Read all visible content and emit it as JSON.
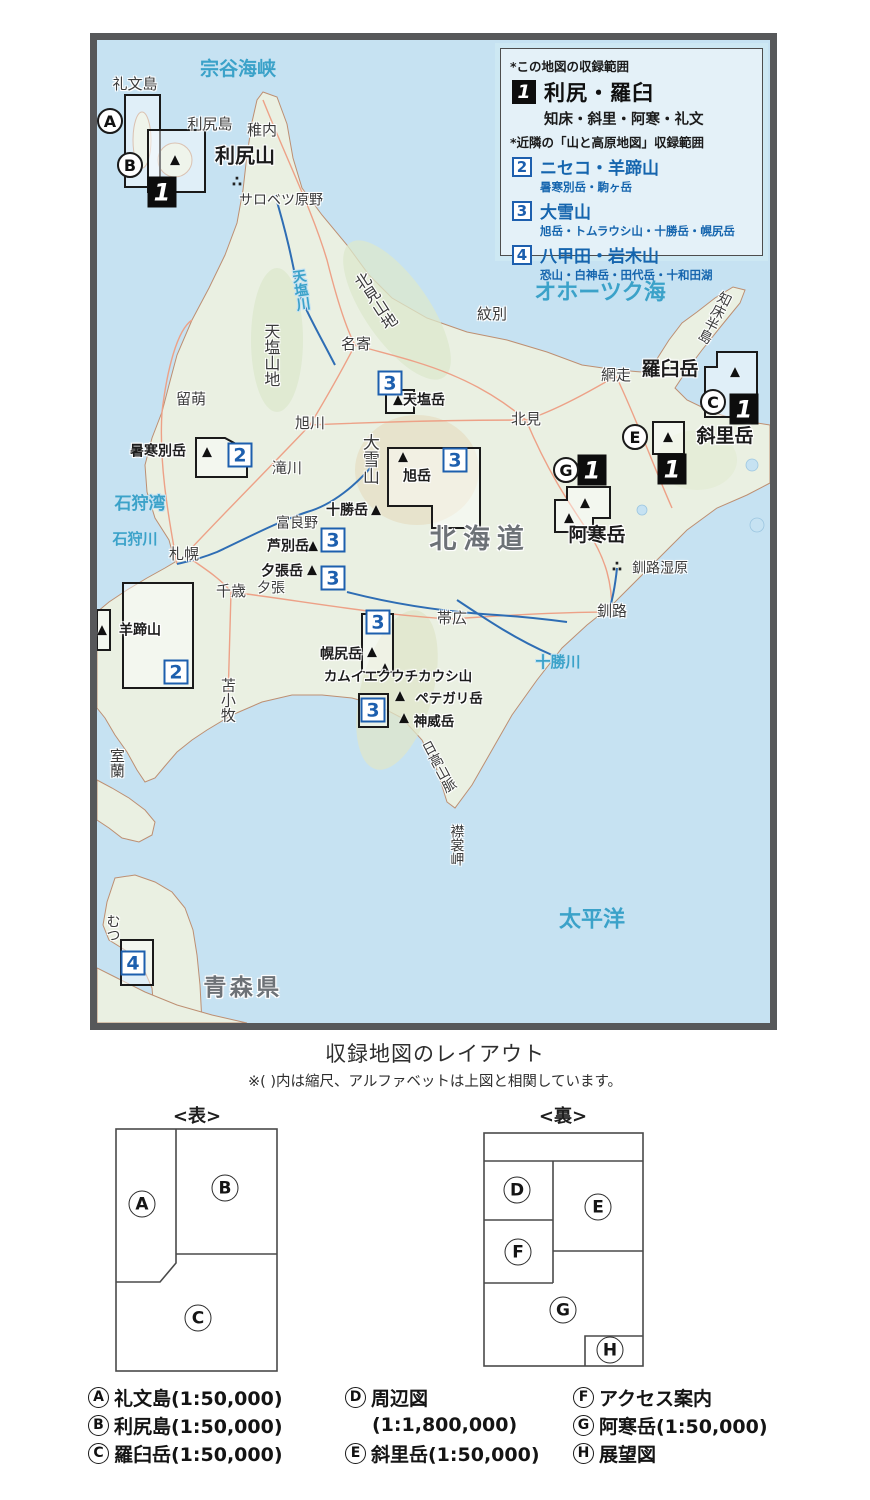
{
  "colors": {
    "ocean": "#c6e2f2",
    "land": "#eaf0e2",
    "coast": "#bd8f72",
    "river": "#2e6db4",
    "road": "#eda187",
    "accent_blue": "#1d5fae",
    "sea_text": "#3ba2c9"
  },
  "legend": {
    "note_this": "*この地図の収録範囲",
    "main": {
      "num": "1",
      "title": "利尻・羅臼",
      "sub": "知床・斜里・阿寒・礼文"
    },
    "note_nearby": "*近隣の「山と高原地図」収録範囲",
    "nearby": [
      {
        "num": "2",
        "title": "ニセコ・羊蹄山",
        "sub": "暑寒別岳・駒ヶ岳"
      },
      {
        "num": "3",
        "title": "大雪山",
        "sub": "旭岳・トムラウシ山・十勝岳・幌尻岳"
      },
      {
        "num": "4",
        "title": "八甲田・岩木山",
        "sub": "恐山・白神岳・田代岳・十和田湖"
      }
    ]
  },
  "map": {
    "labels": [
      {
        "t": "宗谷海峡",
        "x": 141,
        "y": 30,
        "s": 19,
        "c": "sea"
      },
      {
        "t": "オホーツク海",
        "x": 503,
        "y": 253,
        "s": 22,
        "c": "sea"
      },
      {
        "t": "石狩湾",
        "x": 43,
        "y": 465,
        "s": 17,
        "c": "sea"
      },
      {
        "t": "石狩川",
        "x": 38,
        "y": 500,
        "s": 15,
        "c": "sea"
      },
      {
        "t": "天塩川",
        "x": 203,
        "y": 250,
        "s": 14,
        "c": "sea",
        "v": 1,
        "r": -8
      },
      {
        "t": "十勝川",
        "x": 461,
        "y": 623,
        "s": 15,
        "c": "sea"
      },
      {
        "t": "太平洋",
        "x": 495,
        "y": 880,
        "s": 22,
        "c": "sea"
      },
      {
        "t": "礼文島",
        "x": 38,
        "y": 45,
        "s": 15
      },
      {
        "t": "利尻島",
        "x": 113,
        "y": 85,
        "s": 15
      },
      {
        "t": "稚内",
        "x": 165,
        "y": 91,
        "s": 15
      },
      {
        "t": "利尻山",
        "x": 148,
        "y": 116,
        "s": 20,
        "w": 1
      },
      {
        "t": "サロベツ原野",
        "x": 184,
        "y": 161,
        "s": 14
      },
      {
        "t": "北見山地",
        "x": 277,
        "y": 262,
        "s": 16,
        "v": 1,
        "r": -33
      },
      {
        "t": "天塩山地",
        "x": 173,
        "y": 315,
        "s": 16,
        "v": 1
      },
      {
        "t": "名寄",
        "x": 259,
        "y": 305,
        "s": 15
      },
      {
        "t": "紋別",
        "x": 395,
        "y": 275,
        "s": 15
      },
      {
        "t": "留萌",
        "x": 94,
        "y": 360,
        "s": 15
      },
      {
        "t": "旭川",
        "x": 213,
        "y": 384,
        "s": 15
      },
      {
        "t": "滝川",
        "x": 190,
        "y": 429,
        "s": 15
      },
      {
        "t": "網走",
        "x": 519,
        "y": 336,
        "s": 15
      },
      {
        "t": "北見",
        "x": 429,
        "y": 380,
        "s": 15
      },
      {
        "t": "知床半島",
        "x": 617,
        "y": 277,
        "s": 14,
        "v": 1,
        "r": 27
      },
      {
        "t": "羅臼岳",
        "x": 573,
        "y": 330,
        "s": 19,
        "w": 1
      },
      {
        "t": "斜里岳",
        "x": 628,
        "y": 397,
        "s": 19,
        "w": 1
      },
      {
        "t": "天塩岳",
        "x": 327,
        "y": 361,
        "s": 14,
        "w": 1
      },
      {
        "t": "暑寒別岳",
        "x": 61,
        "y": 412,
        "s": 14,
        "w": 1
      },
      {
        "t": "大雪山",
        "x": 271,
        "y": 419,
        "s": 17,
        "v": 1
      },
      {
        "t": "旭岳",
        "x": 320,
        "y": 437,
        "s": 14,
        "w": 1
      },
      {
        "t": "十勝岳",
        "x": 250,
        "y": 471,
        "s": 14,
        "w": 1
      },
      {
        "t": "富良野",
        "x": 200,
        "y": 484,
        "s": 14
      },
      {
        "t": "芦別岳",
        "x": 191,
        "y": 507,
        "s": 14,
        "w": 1
      },
      {
        "t": "夕張岳",
        "x": 185,
        "y": 532,
        "s": 14,
        "w": 1
      },
      {
        "t": "夕張",
        "x": 174,
        "y": 549,
        "s": 14
      },
      {
        "t": "札幌",
        "x": 87,
        "y": 515,
        "s": 15
      },
      {
        "t": "千歳",
        "x": 134,
        "y": 552,
        "s": 15
      },
      {
        "t": "羊蹄山",
        "x": 43,
        "y": 591,
        "s": 14,
        "w": 1
      },
      {
        "t": "苫小牧",
        "x": 130,
        "y": 660,
        "s": 15,
        "v": 1
      },
      {
        "t": "室蘭",
        "x": 19,
        "y": 723,
        "s": 15,
        "v": 1
      },
      {
        "t": "帯広",
        "x": 355,
        "y": 579,
        "s": 15
      },
      {
        "t": "幌尻岳",
        "x": 244,
        "y": 615,
        "s": 14,
        "w": 1
      },
      {
        "t": "カムイエクウチカウシ山",
        "x": 301,
        "y": 637,
        "s": 13.5,
        "w": 1
      },
      {
        "t": "ペテガリ岳",
        "x": 352,
        "y": 659,
        "s": 13.5,
        "w": 1
      },
      {
        "t": "神威岳",
        "x": 337,
        "y": 682,
        "s": 13.5,
        "w": 1
      },
      {
        "t": "日高山脈",
        "x": 341,
        "y": 727,
        "s": 14,
        "v": 1,
        "r": -28
      },
      {
        "t": "襟裳岬",
        "x": 359,
        "y": 805,
        "s": 14,
        "v": 1
      },
      {
        "t": "阿寒岳",
        "x": 500,
        "y": 496,
        "s": 19,
        "w": 1
      },
      {
        "t": "釧路湿原",
        "x": 563,
        "y": 529,
        "s": 14
      },
      {
        "t": "釧路",
        "x": 515,
        "y": 572,
        "s": 15
      },
      {
        "t": "むつ",
        "x": 15,
        "y": 888,
        "s": 14,
        "v": 1
      },
      {
        "t": "北海道",
        "x": 383,
        "y": 500,
        "s": 27,
        "c": "region",
        "ls": 0.25
      },
      {
        "t": "青森県",
        "x": 146,
        "y": 948,
        "s": 23,
        "c": "region",
        "ls": 0.15
      }
    ],
    "badges": [
      {
        "n": "1",
        "x": 65,
        "y": 152,
        "k": "black"
      },
      {
        "n": "1",
        "x": 647,
        "y": 369,
        "k": "black"
      },
      {
        "n": "1",
        "x": 575,
        "y": 429,
        "k": "black"
      },
      {
        "n": "1",
        "x": 495,
        "y": 430,
        "k": "black"
      },
      {
        "n": "2",
        "x": 143,
        "y": 415,
        "k": "blue"
      },
      {
        "n": "2",
        "x": 79,
        "y": 632,
        "k": "blue"
      },
      {
        "n": "3",
        "x": 293,
        "y": 343,
        "k": "blue"
      },
      {
        "n": "3",
        "x": 358,
        "y": 420,
        "k": "blue"
      },
      {
        "n": "3",
        "x": 236,
        "y": 500,
        "k": "blue"
      },
      {
        "n": "3",
        "x": 236,
        "y": 538,
        "k": "blue"
      },
      {
        "n": "3",
        "x": 281,
        "y": 582,
        "k": "blue"
      },
      {
        "n": "3",
        "x": 276,
        "y": 670,
        "k": "blue"
      },
      {
        "n": "4",
        "x": 36,
        "y": 923,
        "k": "blue"
      }
    ],
    "letters": [
      {
        "l": "A",
        "x": 13,
        "y": 81
      },
      {
        "l": "B",
        "x": 33,
        "y": 125
      },
      {
        "l": "C",
        "x": 616,
        "y": 362
      },
      {
        "l": "E",
        "x": 538,
        "y": 397
      },
      {
        "l": "G",
        "x": 469,
        "y": 430
      }
    ],
    "coverage_boxes": [
      "28,55 63,55 63,147 28,147",
      "51,90 108,90 108,152 51,152",
      "620,312 660,312 660,377 608,377 608,327 620,327",
      "556,382 587,382 587,414 556,414",
      "470,447 513,447 513,478 496,478 496,492 458,492 458,460 470,460",
      "99,398 128,398 150,410 150,437 99,437",
      "26,543 96,543 96,648 26,648",
      "0,570 13,570 13,610 0,610",
      "289,350 317,350 317,373 289,373",
      "291,408 383,408 383,488 335,488 335,466 291,466",
      "265,574 296,574 296,632 265,632",
      "262,654 291,654 291,687 262,687",
      "24,900 56,900 56,945 24,945"
    ],
    "peaks": [
      {
        "x": 78,
        "y": 120
      },
      {
        "x": 301,
        "y": 360
      },
      {
        "x": 110,
        "y": 412
      },
      {
        "x": 306,
        "y": 417
      },
      {
        "x": 279,
        "y": 470
      },
      {
        "x": 216,
        "y": 506
      },
      {
        "x": 215,
        "y": 530
      },
      {
        "x": 5,
        "y": 590
      },
      {
        "x": 275,
        "y": 612
      },
      {
        "x": 288,
        "y": 628
      },
      {
        "x": 303,
        "y": 656
      },
      {
        "x": 307,
        "y": 678
      },
      {
        "x": 638,
        "y": 332
      },
      {
        "x": 571,
        "y": 397
      },
      {
        "x": 472,
        "y": 478
      },
      {
        "x": 488,
        "y": 463
      }
    ],
    "wetlands": [
      {
        "x": 140,
        "y": 142
      },
      {
        "x": 520,
        "y": 527
      }
    ]
  },
  "layout_section": {
    "title": "収録地図のレイアウト",
    "note": "※( )内は縮尺、アルファベットは上図と相関しています。",
    "front_label": "<表>",
    "back_label": "<裏>",
    "front_letters": [
      {
        "l": "A",
        "x": 27,
        "y": 76
      },
      {
        "l": "B",
        "x": 110,
        "y": 60
      },
      {
        "l": "C",
        "x": 83,
        "y": 190
      }
    ],
    "back_letters": [
      {
        "l": "D",
        "x": 34,
        "y": 58
      },
      {
        "l": "E",
        "x": 115,
        "y": 75
      },
      {
        "l": "F",
        "x": 35,
        "y": 120
      },
      {
        "l": "G",
        "x": 80,
        "y": 178
      },
      {
        "l": "H",
        "x": 127,
        "y": 218
      }
    ],
    "columns": [
      [
        {
          "l": "A",
          "t": "礼文島(1:50,000)"
        },
        {
          "l": "B",
          "t": "利尻島(1:50,000)"
        },
        {
          "l": "C",
          "t": "羅臼岳(1:50,000)"
        }
      ],
      [
        {
          "l": "D",
          "t": "周辺図"
        },
        {
          "t": "(1:1,800,000)"
        },
        {
          "l": "E",
          "t": "斜里岳(1:50,000)"
        }
      ],
      [
        {
          "l": "F",
          "t": "アクセス案内"
        },
        {
          "l": "G",
          "t": "阿寒岳(1:50,000)"
        },
        {
          "l": "H",
          "t": "展望図"
        }
      ]
    ]
  }
}
